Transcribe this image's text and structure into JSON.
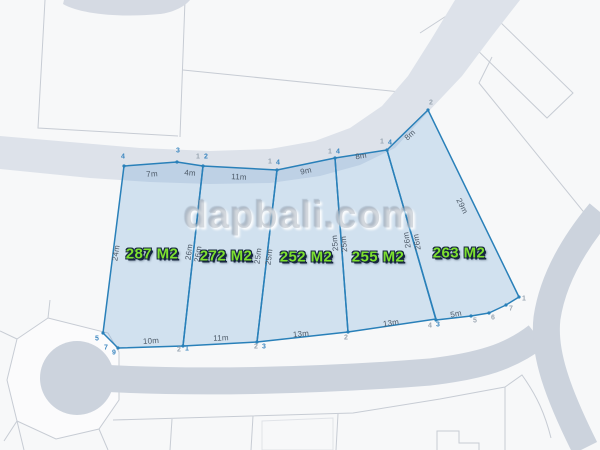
{
  "watermark": "dapbali.com",
  "plan": {
    "parcels": [
      {
        "area": "287 M2",
        "sides": {
          "top_a": "7m",
          "top_b": "4m",
          "bottom": "10m",
          "left": "24m",
          "right": "26m"
        }
      },
      {
        "area": "272 M2",
        "sides": {
          "top": "11m",
          "bottom": "11m",
          "left": "26m",
          "right": "25m"
        }
      },
      {
        "area": "252 M2",
        "sides": {
          "top": "9m",
          "bottom": "13m",
          "left": "25m",
          "right": "25m"
        }
      },
      {
        "area": "255 M2",
        "sides": {
          "top": "8m",
          "bottom": "13m",
          "left": "25m",
          "right": "26m"
        }
      },
      {
        "area": "263 M2",
        "sides": {
          "top": "8m",
          "bottom": "5m",
          "left": "26m",
          "right": "29m"
        }
      }
    ],
    "corner_markers": {
      "t1": "4",
      "t2": "3",
      "t3a": "1",
      "t3b": "2",
      "t4a": "1",
      "t4b": "4",
      "t5a": "1",
      "t5b": "4",
      "t6a": "1",
      "t6b": "4",
      "t7": "2",
      "b1": "5",
      "b2": "7",
      "b3": "9",
      "b4a": "2",
      "b4b": "1",
      "b5a": "2",
      "b5b": "3",
      "b6": "2",
      "b7a": "4",
      "b7b": "3",
      "b8": "5",
      "b9": "6",
      "b10": "7",
      "b11": "1"
    },
    "colors": {
      "parcel_stroke": "#2980b9",
      "parcel_fill": "#dbe7f3",
      "area_label_green": "#7de02f",
      "road_light": "#dde2ea",
      "road_dark": "#ccd3dd",
      "background": "#f7f8f9"
    }
  }
}
